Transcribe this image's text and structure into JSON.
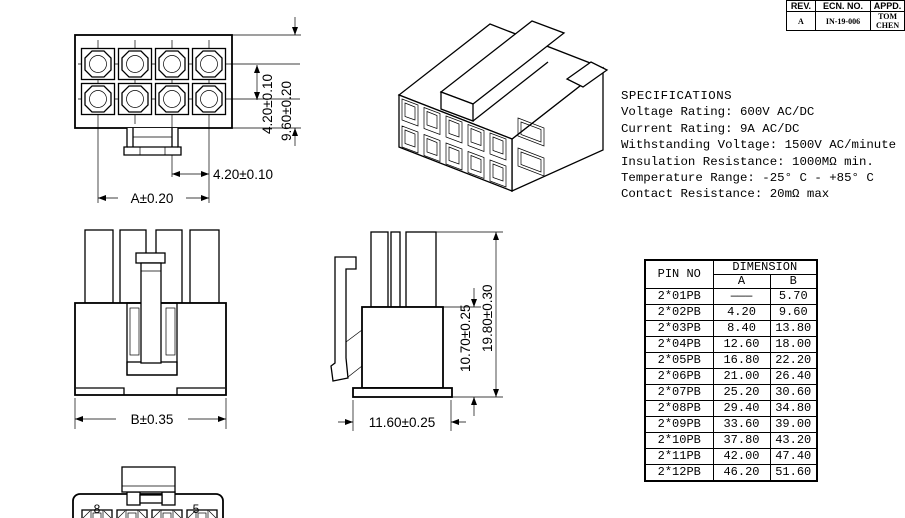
{
  "rev_block": {
    "headers": [
      "REV.",
      "ECN. NO.",
      "APPD."
    ],
    "row": {
      "rev": "A",
      "ecn_no": "IN-19-006",
      "appd": "TOM CHEN"
    }
  },
  "specifications": {
    "title": "SPECIFICATIONS",
    "lines": [
      "Voltage Rating: 600V AC/DC",
      "Current Rating: 9A AC/DC",
      "Withstanding Voltage: 1500V AC/minute",
      "Insulation Resistance: 1000MΩ min.",
      "Temperature Range: -25° C - +85° C",
      "Contact Resistance: 20mΩ max"
    ]
  },
  "pin_table": {
    "col_pin": "PIN NO",
    "col_dimension": "DIMENSION",
    "col_a": "A",
    "col_b": "B",
    "rows": [
      {
        "pin": "2*01PB",
        "a": "———",
        "b": "5.70"
      },
      {
        "pin": "2*02PB",
        "a": "4.20",
        "b": "9.60"
      },
      {
        "pin": "2*03PB",
        "a": "8.40",
        "b": "13.80"
      },
      {
        "pin": "2*04PB",
        "a": "12.60",
        "b": "18.00"
      },
      {
        "pin": "2*05PB",
        "a": "16.80",
        "b": "22.20"
      },
      {
        "pin": "2*06PB",
        "a": "21.00",
        "b": "26.40"
      },
      {
        "pin": "2*07PB",
        "a": "25.20",
        "b": "30.60"
      },
      {
        "pin": "2*08PB",
        "a": "29.40",
        "b": "34.80"
      },
      {
        "pin": "2*09PB",
        "a": "33.60",
        "b": "39.00"
      },
      {
        "pin": "2*10PB",
        "a": "37.80",
        "b": "43.20"
      },
      {
        "pin": "2*11PB",
        "a": "42.00",
        "b": "47.40"
      },
      {
        "pin": "2*12PB",
        "a": "46.20",
        "b": "51.60"
      }
    ]
  },
  "front_view": {
    "dim_row_pitch": "4.20±0.10",
    "dim_height": "9.60±0.20",
    "dim_col_pitch": "4.20±0.10",
    "dim_width": "A±0.20"
  },
  "rear_view": {
    "dim_width": "B±0.35"
  },
  "side_view": {
    "dim_body_height": "10.70±0.25",
    "dim_total_height": "19.80±0.30",
    "dim_depth": "11.60±0.25"
  },
  "bottom_view": {
    "pin_label_left": "8",
    "pin_label_right": "5"
  },
  "colors": {
    "line": "#000000",
    "background": "#ffffff"
  }
}
